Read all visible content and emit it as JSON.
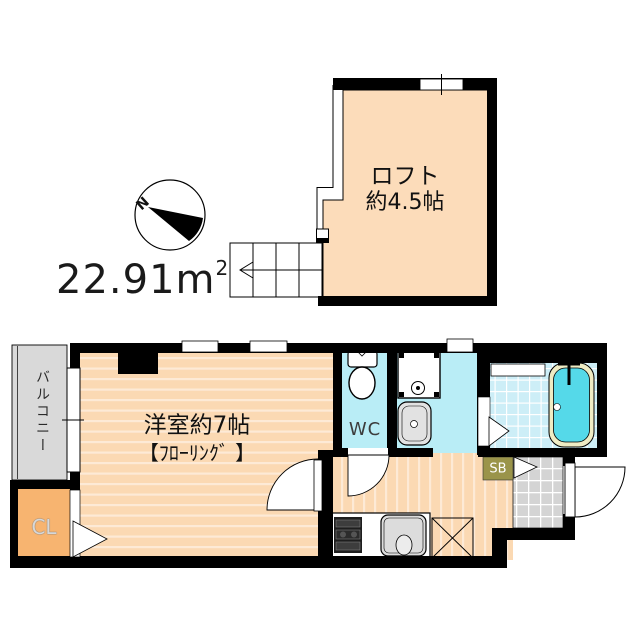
{
  "plan": {
    "area": {
      "value": "22.91m",
      "superscript": "2"
    },
    "compass": {
      "north": "N"
    },
    "loft": {
      "label": "ロフト",
      "size": "約4.5帖"
    },
    "main_room": {
      "label": "洋室約7帖",
      "sub_label": "【ﾌﾛｰﾘﾝｸﾞ 】"
    },
    "balcony": {
      "label": "バルコニー"
    },
    "closet": {
      "label": "CL"
    },
    "toilet": {
      "label": "WC"
    },
    "shoe_box": {
      "label": "SB"
    },
    "colors": {
      "wall": "#000000",
      "background": "#ffffff",
      "loft_floor": "#fcdcba",
      "room_floor": "#fbd9b3",
      "room_floor_stripe": "#fdead6",
      "wet_area": "#b9edf6",
      "bath_tile": "#cdeef7",
      "bathtub_water": "#55d9e9",
      "bathtub_rim": "#efecc4",
      "closet_fill": "#f7b470",
      "balcony_fill": "#d9d9d9",
      "entrance_tile": "#d4d4d4",
      "shoe_box_fill": "#9a944a"
    }
  }
}
